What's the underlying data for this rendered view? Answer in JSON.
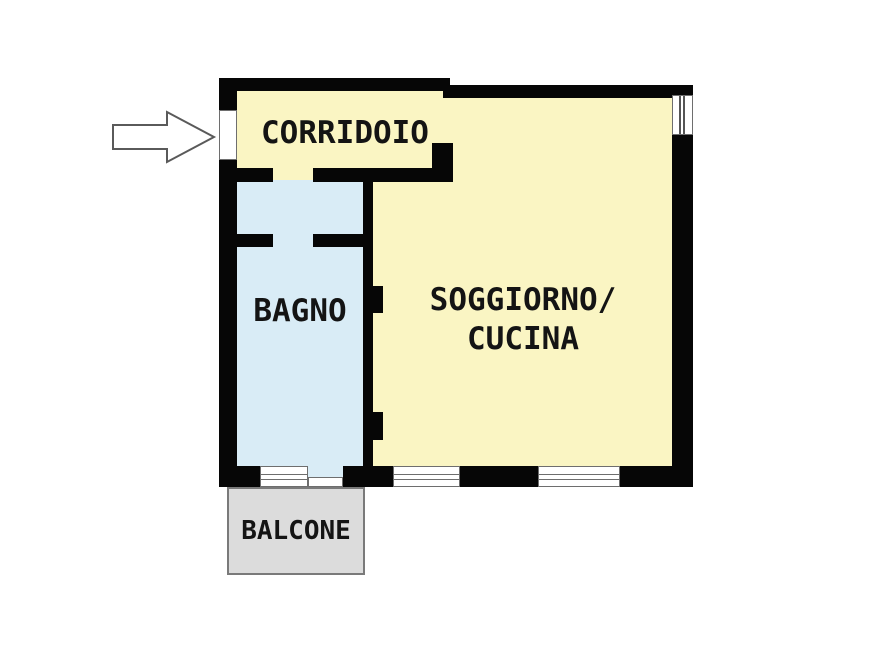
{
  "page": {
    "background": "#ffffff"
  },
  "floorplan": {
    "rooms": {
      "corridoio": {
        "label": "CORRIDOIO",
        "fill": "#faf5c3"
      },
      "bagno": {
        "label": "BAGNO",
        "fill": "#d9ecf6"
      },
      "soggiorno_cucina": {
        "label_line1": "SOGGIORNO/",
        "label_line2": "CUCINA",
        "fill": "#faf5c3"
      },
      "balcone": {
        "label": "BALCONE",
        "fill": "#dcdcdc"
      }
    },
    "entrance": {
      "icon": "arrow-right-icon",
      "points_to": "entrance-door"
    },
    "colors": {
      "wall": "#060606",
      "window": "#ffffff",
      "window_frame": "#6e6e6e",
      "balcony_border": "#7a7a7a",
      "label_text": "#141414",
      "arrow_outline": "#5a5a5a"
    }
  }
}
